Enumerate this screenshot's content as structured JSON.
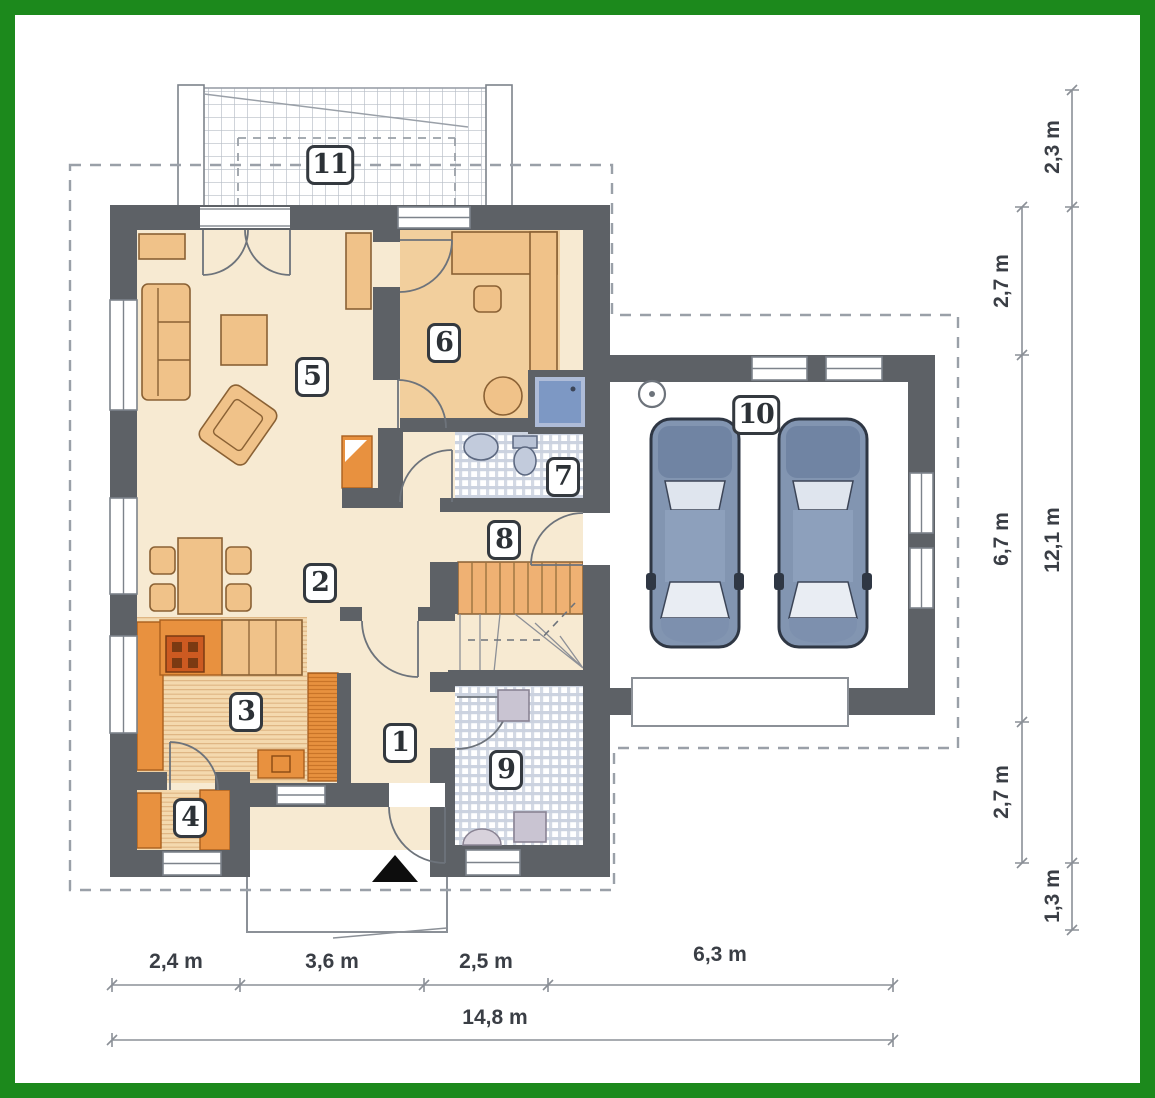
{
  "plan": {
    "rooms": [
      {
        "number": "1"
      },
      {
        "number": "2"
      },
      {
        "number": "3"
      },
      {
        "number": "4"
      },
      {
        "number": "5"
      },
      {
        "number": "6"
      },
      {
        "number": "7"
      },
      {
        "number": "8"
      },
      {
        "number": "9"
      },
      {
        "number": "10"
      },
      {
        "number": "11"
      }
    ],
    "dims_bottom": [
      "2,4 m",
      "3,6 m",
      "2,5 m",
      "6,3 m"
    ],
    "dim_bottom_total": "14,8 m",
    "dims_right_inner": [
      "2,7 m",
      "6,7 m",
      "2,7 m"
    ],
    "dims_right_outer": [
      "2,3 m",
      "12,1 m",
      "1,3 m"
    ],
    "colors": {
      "frame-green": "#1c891c",
      "wall-gray": "#5d6166",
      "floor-cream": "#f7ead2",
      "floor-tan": "#f2cf9d",
      "accent-orange": "#e8913f",
      "furniture-light": "#f0c289",
      "car-blue": "#8295b1",
      "tile-line": "#ccd3e0",
      "dash-gray": "#9aa0a8",
      "dim-gray": "#3a3e45"
    }
  }
}
